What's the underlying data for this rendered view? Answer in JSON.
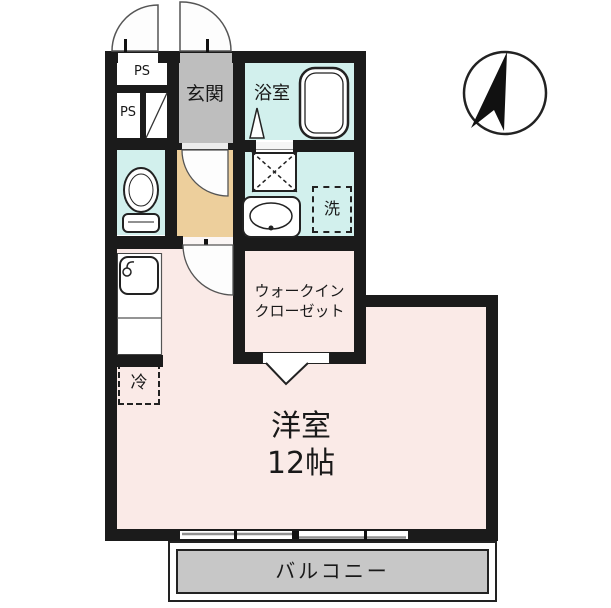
{
  "plan": {
    "rooms": {
      "ps_top": {
        "label": "PS"
      },
      "ps_bottom": {
        "label": "PS"
      },
      "entrance": {
        "label": "玄関"
      },
      "bathroom": {
        "label": "浴室"
      },
      "laundry": {
        "label": "洗"
      },
      "walk_in_closet": {
        "label_line1": "ウォークイン",
        "label_line2": "クローゼット"
      },
      "western_room": {
        "label": "洋室",
        "size": "12帖"
      },
      "refrigerator": {
        "label": "冷"
      },
      "balcony": {
        "label": "バルコニー"
      }
    },
    "colors": {
      "wall": "#1b1b1b",
      "entrance_floor": "#bebebe",
      "wet_area_floor": "#d2f0ed",
      "hall_floor": "#edcf9c",
      "closet_floor": "#e5a33c",
      "room_floor": "#faeae7",
      "balcony_floor": "#c7c7c7"
    }
  }
}
